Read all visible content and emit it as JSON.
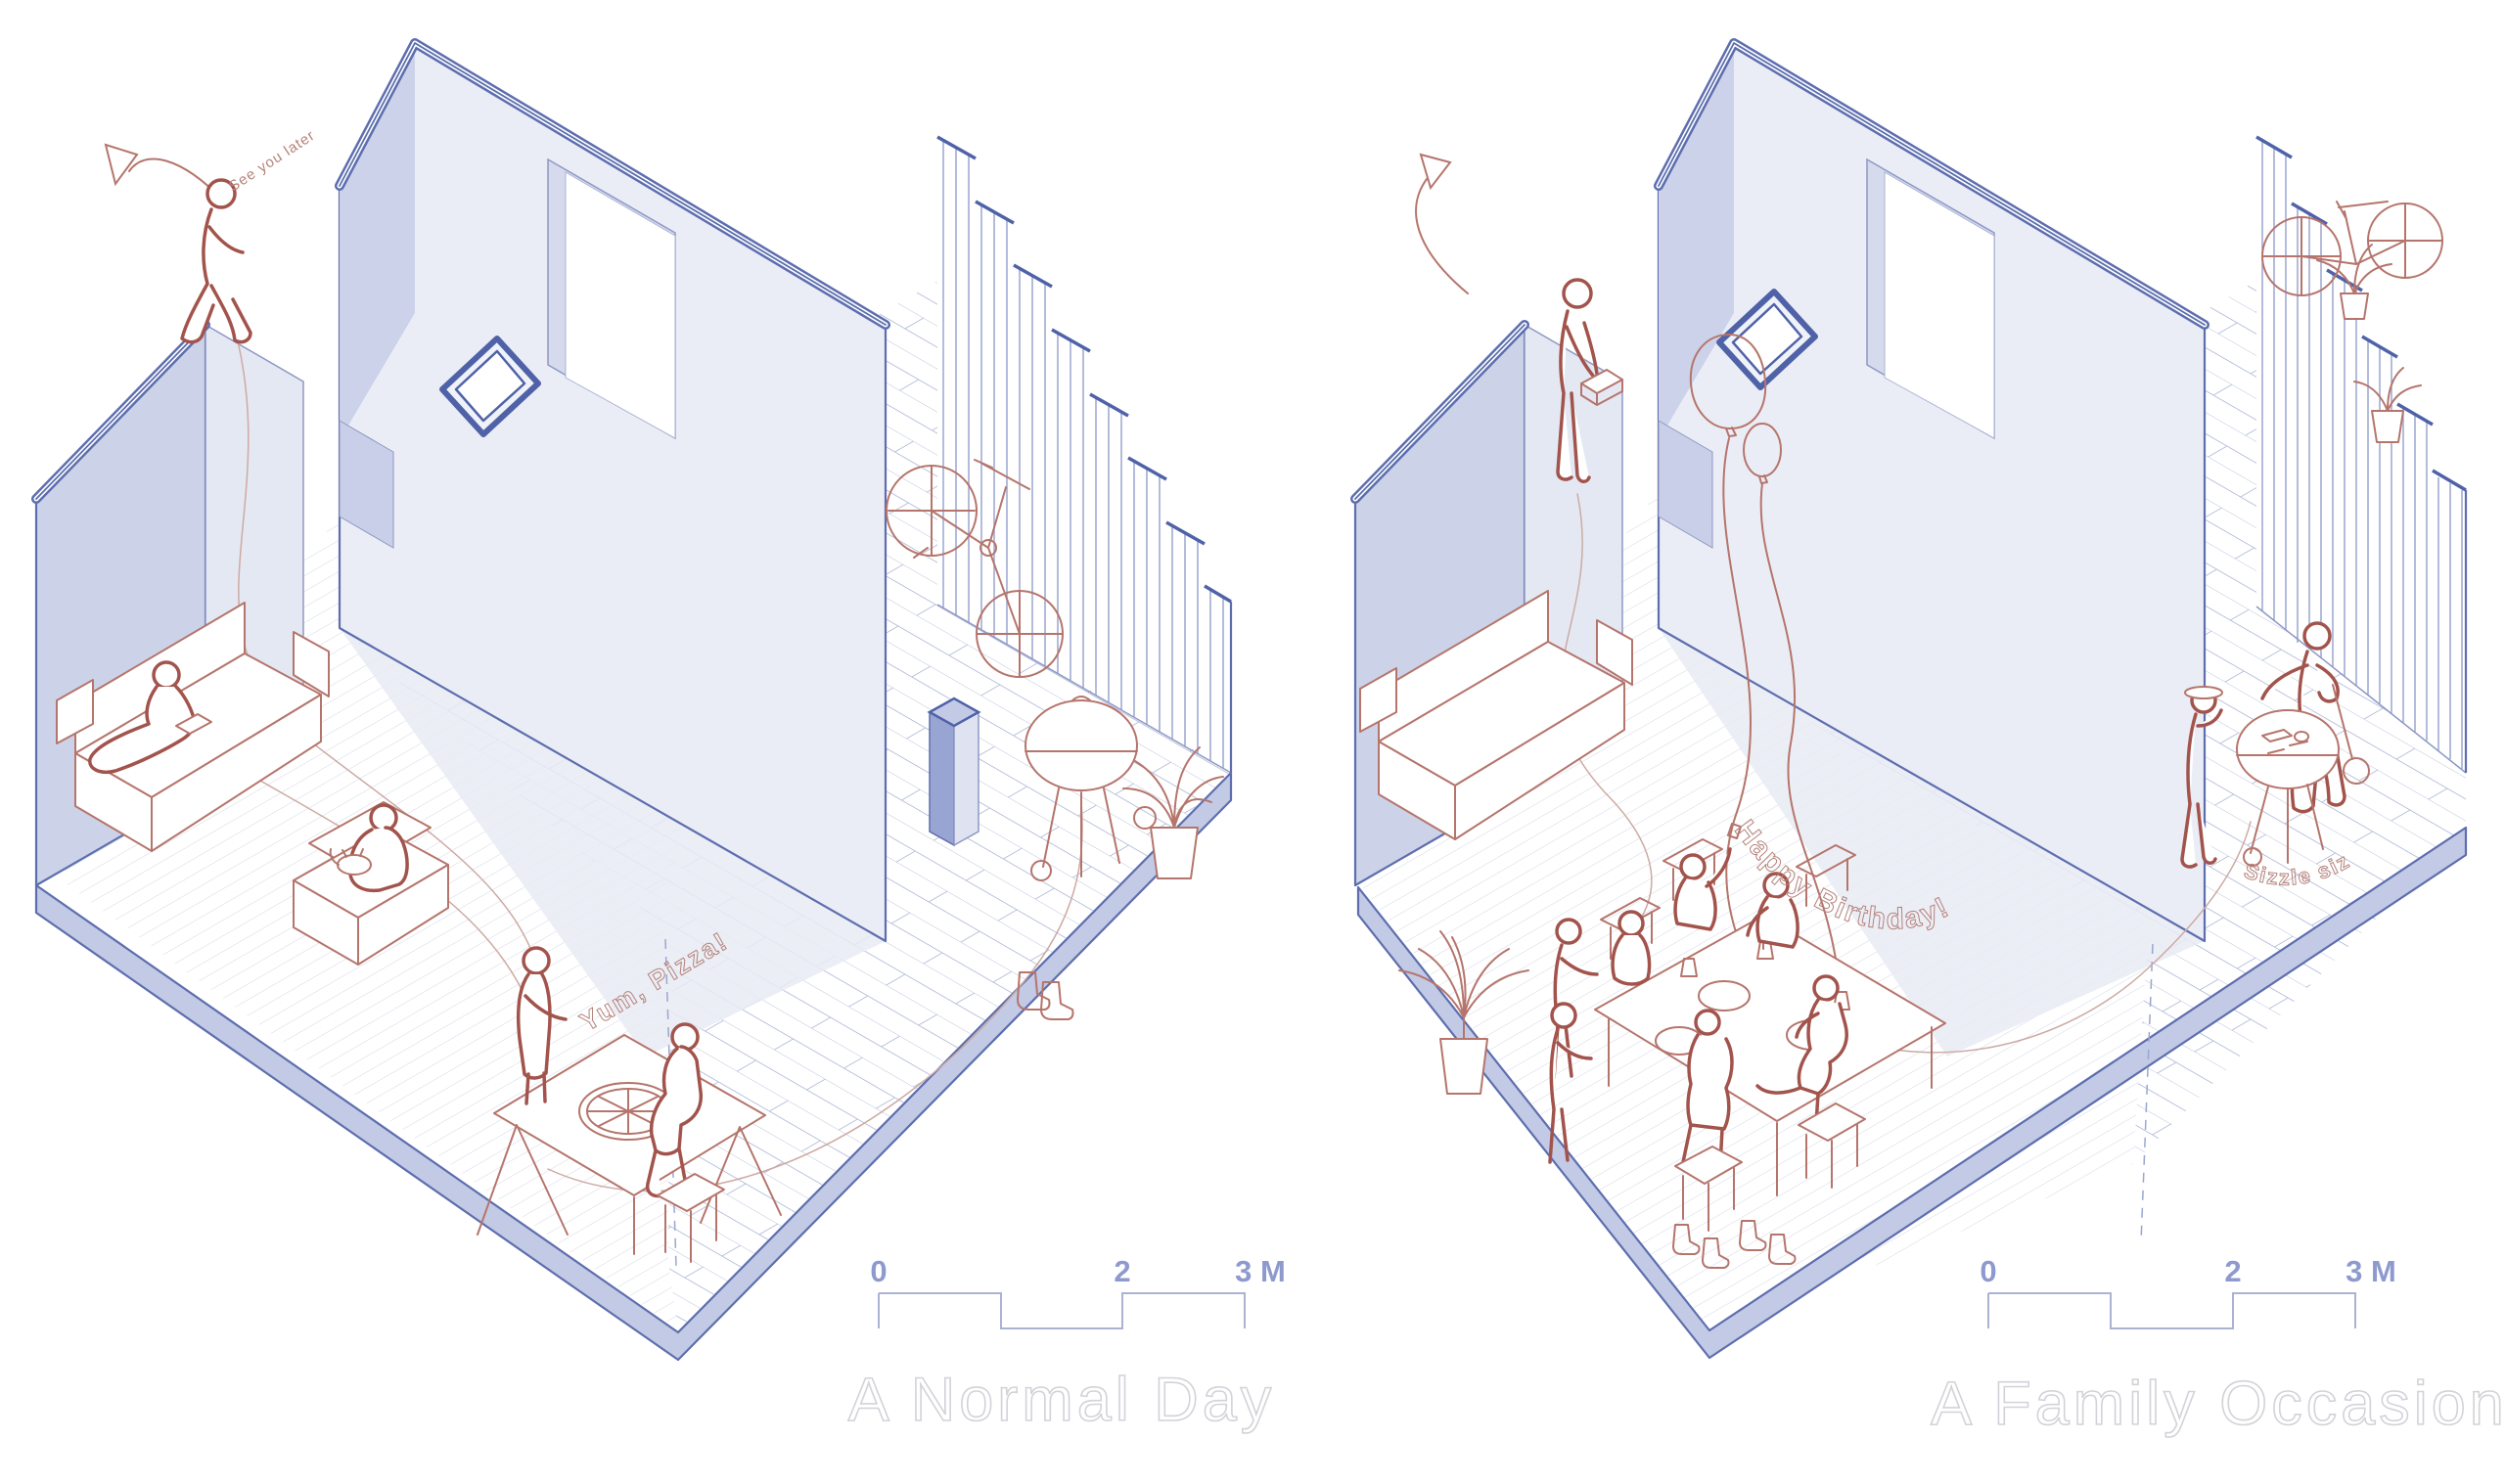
{
  "scene": {
    "type": "isometric architectural cutaway diagram",
    "panels": 2
  },
  "left_panel": {
    "title": "A Normal Day",
    "annotations": {
      "see_you_later": "See you later",
      "yum_pizza": "Yum, Pizza!"
    },
    "scale_bar": {
      "tick0": "0",
      "tick2": "2",
      "tick3": "3 M"
    }
  },
  "right_panel": {
    "title": "A Family Occasion",
    "annotations": {
      "happy_birthday": "Happy Birthday!",
      "sizzle_sizzle": "Sizzle sizzle"
    },
    "scale_bar": {
      "tick0": "0",
      "tick2": "2",
      "tick3": "3 M"
    }
  },
  "colors": {
    "wall_edge": "#5d6eae",
    "wall_face": "#ebedf6",
    "wall_side": "#ccd3e9",
    "plinth": "#c3cae5",
    "figure_outline": "#a2544c",
    "furniture_outline": "#b5756c",
    "annotation_text": "#b5837b",
    "scale_label": "#8e9ace",
    "title_outline": "#d2d3d8"
  }
}
